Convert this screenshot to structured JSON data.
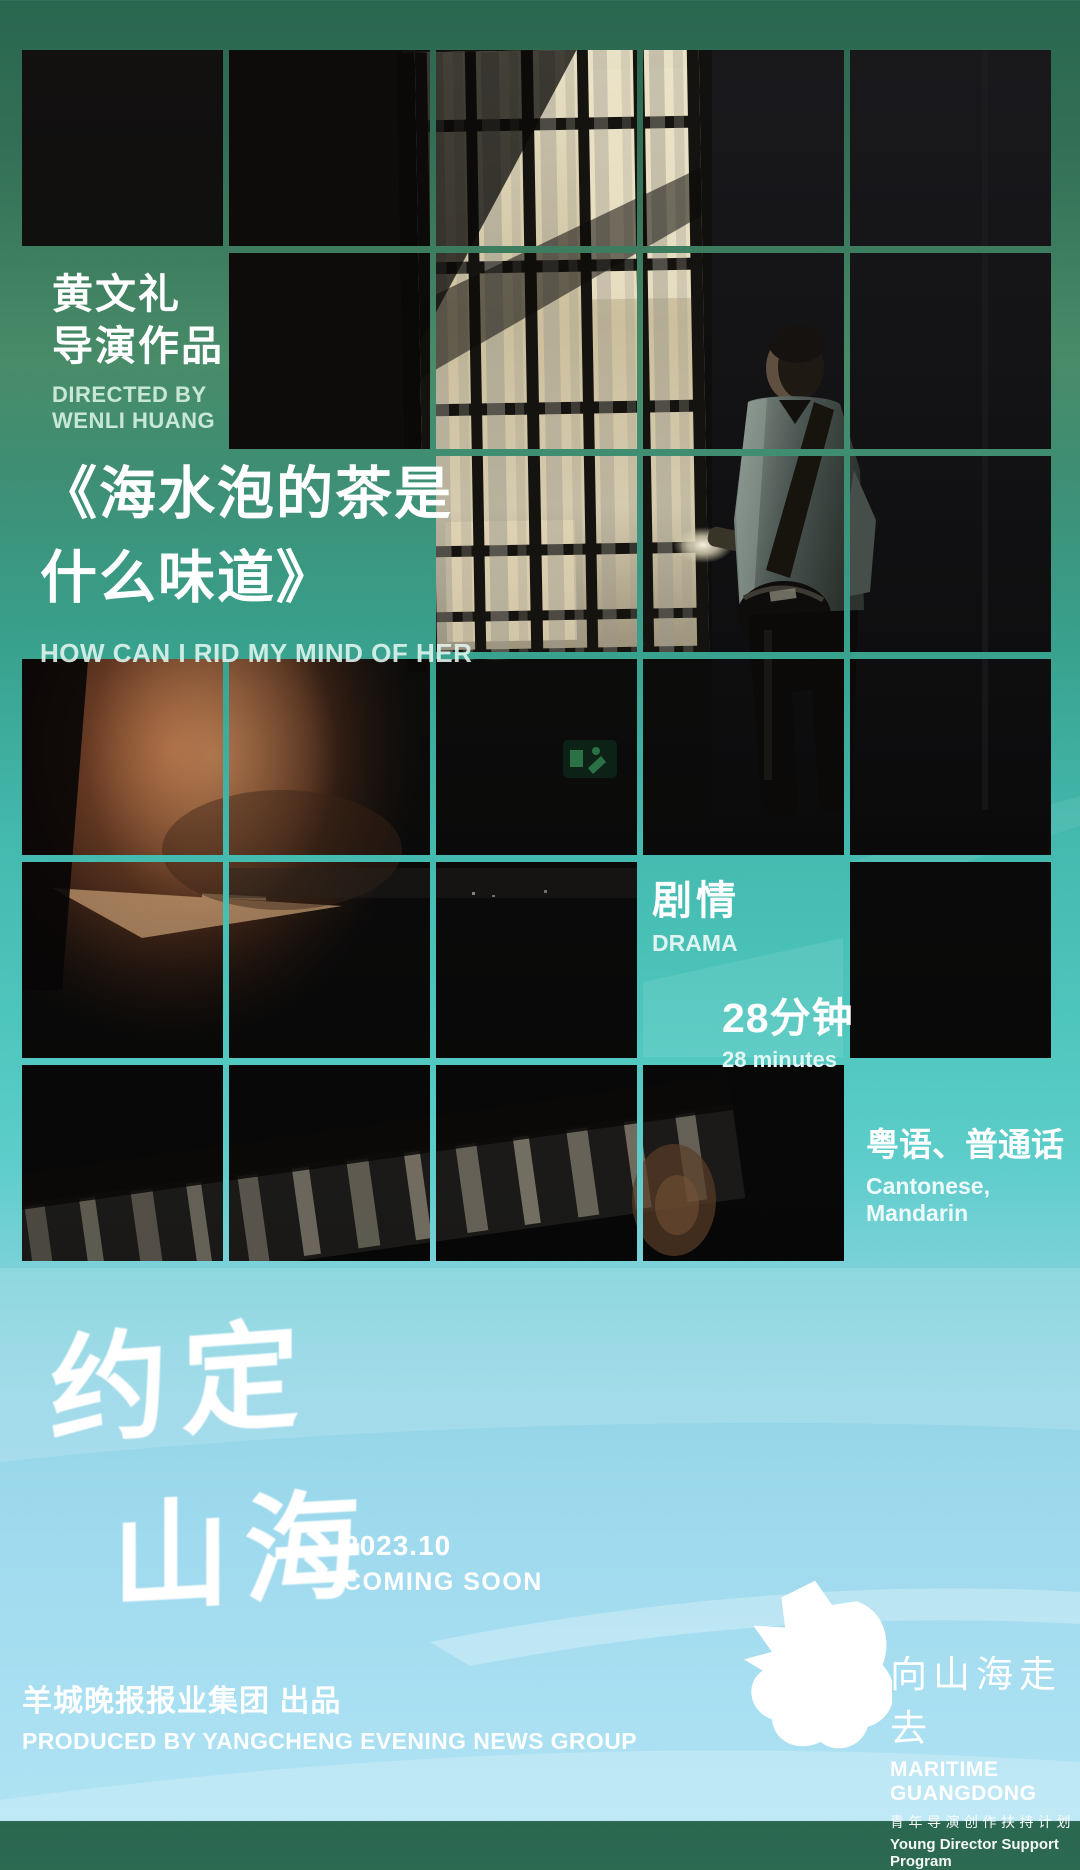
{
  "poster": {
    "director_credit": {
      "zh_line1": "黄文礼",
      "zh_line2": "导演作品",
      "en_line1": "DIRECTED BY",
      "en_line2": "WENLI HUANG"
    },
    "title": {
      "zh_line1": "《海水泡的茶是",
      "zh_line2": "什么味道》",
      "en": "HOW CAN I RID MY MIND OF HER"
    },
    "genre": {
      "zh": "剧情",
      "en": "DRAMA"
    },
    "duration": {
      "zh": "28分钟",
      "en": "28 minutes"
    },
    "language": {
      "zh": "粤语、普通话",
      "en": "Cantonese,  Mandarin"
    },
    "campaign": {
      "brand_line1": "约定",
      "brand_line2": "山海",
      "date": "2023.10",
      "status": "COMING SOON"
    },
    "producer": {
      "zh": "羊城晚报报业集团 出品",
      "en": "PRODUCED BY YANGCHENG EVENING NEWS GROUP"
    },
    "program_logo": {
      "zh_name": "向山海走去",
      "en_name": "MARITIME GUANGDONG",
      "zh_sub": "青年导演创作扶持计划",
      "en_sub": "Young Director Support Program"
    },
    "colors": {
      "gradient_top_green": "#2a6750",
      "gradient_mid_teal": "#4dc6bd",
      "gradient_bottom_blue": "#afe3f4",
      "text_primary": "#ffffff",
      "text_secondary_green": "#c9e7d6"
    }
  }
}
